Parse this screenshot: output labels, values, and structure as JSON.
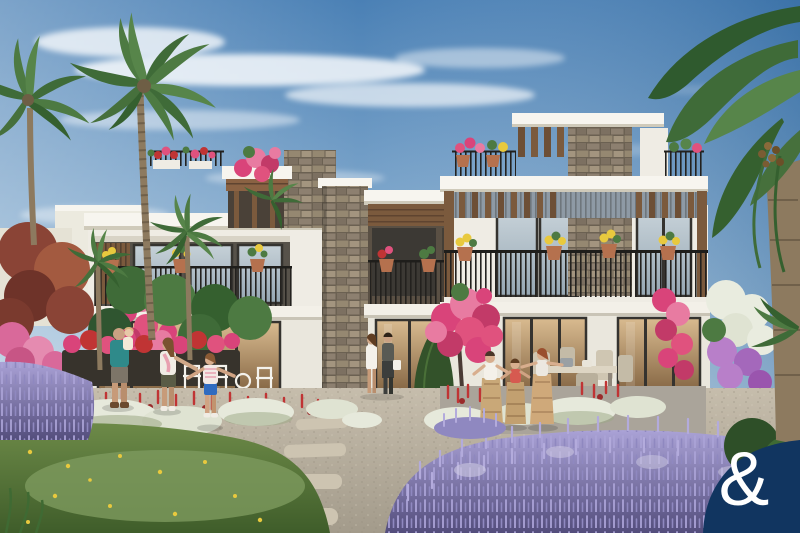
{
  "image": {
    "width_px": 800,
    "height_px": 533,
    "type": "3D architectural exterior render",
    "subject": "Contemporary white townhouse community with landscaped flower gardens"
  },
  "brand": {
    "logo_symbol": "&",
    "logo_bg": "#113560",
    "logo_fg": "#ffffff",
    "logo_position": "bottom-right rounded badge"
  },
  "palette": {
    "sky_top": "#4a80b5",
    "sky_mid": "#93b6d4",
    "sky_horizon": "#dae7ef",
    "cloud": "#ffffff",
    "wall_white": "#efece4",
    "slab_white": "#f7f5ef",
    "stone": "#8d8070",
    "wood": "#7b5a3d",
    "window_frame": "#35332f",
    "glass_warm": "#b98f63",
    "glass_cool": "#b9c6cf",
    "railing": "#23211e",
    "terracotta": "#b5714e",
    "flower_pink": "#e0527e",
    "flower_red": "#c03434",
    "flower_yellow": "#e8c93e",
    "lavender": "#9e98cb",
    "lavender_deep": "#5b5583",
    "lawn": "#5d7b3d",
    "clover": "#7d9a5e",
    "gravel": "#b9b1a2",
    "palm_green": "#4d7a42",
    "shrub_dark": "#32512c",
    "white_flower": "#e9ecdf",
    "trunk": "#8d7a5f",
    "skin": "#caa183"
  },
  "scene": {
    "sky": "Blue sky with wispy white clouds upper-left, deeper clear blue to the right",
    "architecture": "Row of white modern townhouses with stone-clad feature columns, timber pergolas and soffits, black-framed glazing, black metal balcony railings and terracotta planters of red, pink and yellow flowers with climbing bougainvillea",
    "vegetation": "Tall coconut palms on the left, overhanging palm fronds top-right, lavender drifts, white flowering shrubs, rows of red salvia, clipped shrubs, lawn with dandelions, gravel paths with stepping stones",
    "people": [
      "father carrying a toddler",
      "mother walking hand-in-hand with a girl",
      "couple strolling along the glazed facade",
      "three children racing in burlap sacks"
    ],
    "furnishing": [
      "white garden chairs on the left terrace",
      "outdoor dining table and chairs on the right terrace"
    ]
  }
}
